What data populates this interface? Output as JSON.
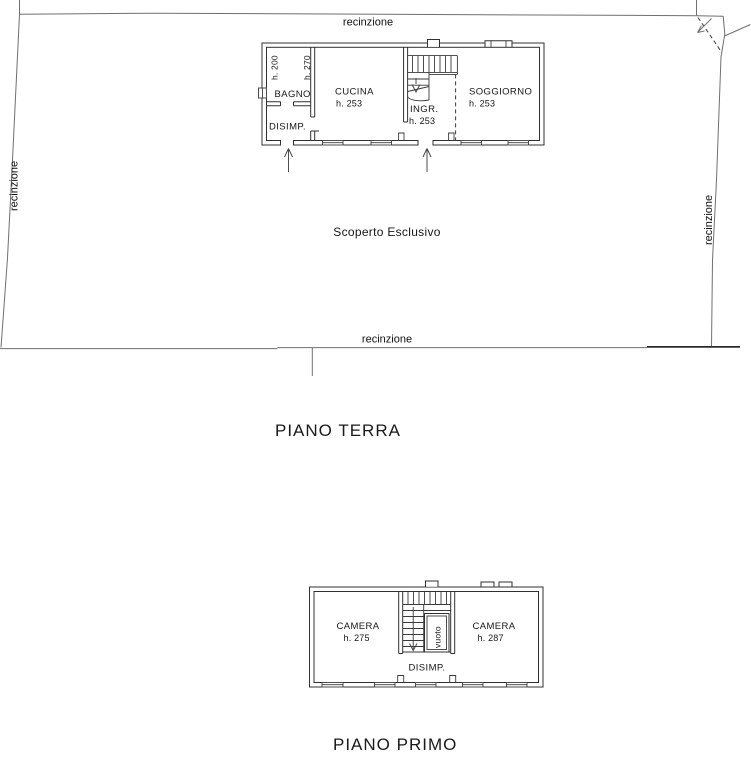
{
  "colors": {
    "background": "#ffffff",
    "wall_line": "#303030",
    "fence_line": "#6f6f6f",
    "text": "#161616"
  },
  "site": {
    "fence_label_top": "recinzione",
    "fence_label_left": "recinzione",
    "fence_label_right": "recinzione",
    "fence_label_bottom": "recinzione",
    "courtyard_label": "Scoperto Esclusivo"
  },
  "ground_floor": {
    "title": "PIANO TERRA",
    "rooms": {
      "bagno": {
        "name": "BAGNO",
        "height_a": "h. 200",
        "height_b": "h. 270"
      },
      "disimp": {
        "name": "DISIMP."
      },
      "cucina": {
        "name": "CUCINA",
        "height": "h. 253"
      },
      "ingresso": {
        "name": "INGR.",
        "height": "h. 253"
      },
      "soggiorno": {
        "name": "SOGGIORNO",
        "height": "h. 253"
      }
    }
  },
  "first_floor": {
    "title": "PIANO PRIMO",
    "rooms": {
      "camera_left": {
        "name": "CAMERA",
        "height": "h. 275"
      },
      "camera_right": {
        "name": "CAMERA",
        "height": "h. 287"
      },
      "disimp": {
        "name": "DISIMP."
      },
      "vuoto": {
        "name": "vuoto"
      }
    }
  }
}
